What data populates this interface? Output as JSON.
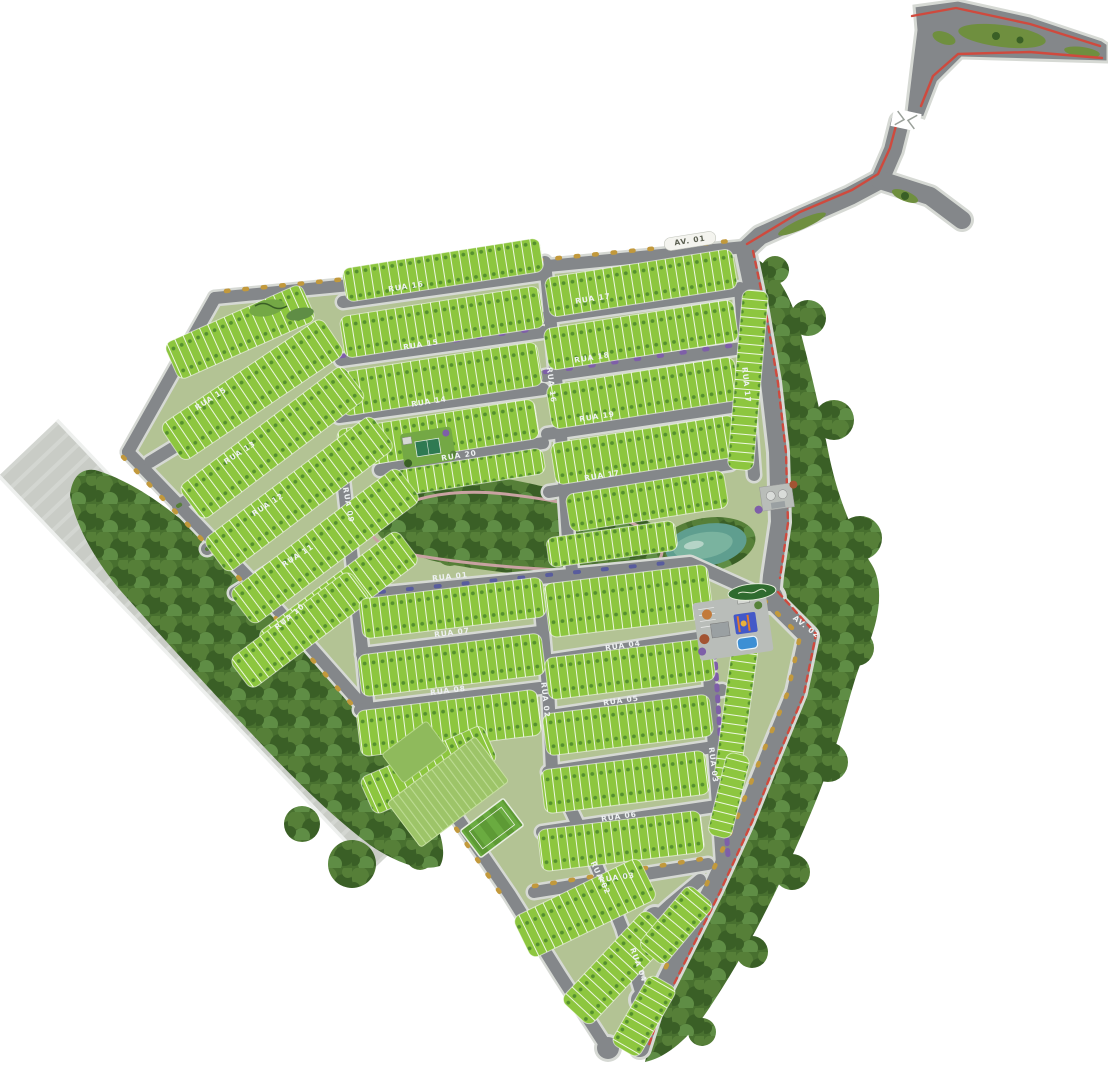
{
  "map_title": "Residential lot subdivision master plan",
  "colors": {
    "lot": "#8dc63f",
    "lotTree": "#4f8a2d",
    "ground": "#b3c394",
    "road": "#84878a",
    "roadCasing": "#d6d9d4",
    "forest": "#48702f",
    "forest2": "#567f38",
    "forest3": "#3a5f26",
    "forest4": "#5f8d45",
    "band": "#c9ccc6",
    "bandEdge": "#eef0ee",
    "lake": "#5f9e8f",
    "lakeLight": "#7fb6a2",
    "trail": "#c9a2a2",
    "red": "#cf4a3e",
    "amber": "#c2993c",
    "purple": "#7e5fa8",
    "carBlue": "#585c9d",
    "court": "#2f7a52",
    "pool": "#3d8fd4",
    "clubBlue": "#4459c8",
    "clubOrange": "#e07b2f",
    "paving": "#b9bdb9",
    "soccer": "#5d9a35",
    "soccer2": "#6aab40",
    "orchard": "#9dc468",
    "orchardLine": "#bddc93",
    "island": "#6f8f3f",
    "sign": "#2f6b2f"
  },
  "streets": [
    {
      "label": "RUA 16",
      "x": 406,
      "y": 287,
      "rot": -9
    },
    {
      "label": "RUA 15",
      "x": 421,
      "y": 345,
      "rot": -9
    },
    {
      "label": "RUA 14",
      "x": 429,
      "y": 402,
      "rot": -9
    },
    {
      "label": "RUA 20",
      "x": 459,
      "y": 456,
      "rot": -9
    },
    {
      "label": "RUA 17",
      "x": 593,
      "y": 299,
      "rot": -9
    },
    {
      "label": "RUA 18",
      "x": 592,
      "y": 358,
      "rot": -9
    },
    {
      "label": "RUA 19",
      "x": 597,
      "y": 417,
      "rot": -9
    },
    {
      "label": "RUA 17",
      "x": 602,
      "y": 476,
      "rot": -9
    },
    {
      "label": "RUA 16",
      "x": 551,
      "y": 385,
      "rot": 83
    },
    {
      "label": "RUA 17",
      "x": 746,
      "y": 385,
      "rot": 84
    },
    {
      "label": "RUA 09",
      "x": 348,
      "y": 505,
      "rot": 80
    },
    {
      "label": "RUA 15",
      "x": 211,
      "y": 399,
      "rot": -33
    },
    {
      "label": "RUA 13",
      "x": 240,
      "y": 453,
      "rot": -33
    },
    {
      "label": "RUA 12",
      "x": 268,
      "y": 505,
      "rot": -33
    },
    {
      "label": "RUA 11",
      "x": 298,
      "y": 556,
      "rot": -33
    },
    {
      "label": "RUA 10",
      "x": 290,
      "y": 617,
      "rot": -40
    },
    {
      "label": "RUA 01",
      "x": 450,
      "y": 577,
      "rot": -6
    },
    {
      "label": "RUA 07",
      "x": 452,
      "y": 633,
      "rot": -7
    },
    {
      "label": "RUA 08",
      "x": 448,
      "y": 691,
      "rot": -7
    },
    {
      "label": "RUA 02",
      "x": 545,
      "y": 700,
      "rot": 84
    },
    {
      "label": "RUA 04",
      "x": 623,
      "y": 646,
      "rot": -8
    },
    {
      "label": "RUA 05",
      "x": 621,
      "y": 701,
      "rot": -8
    },
    {
      "label": "RUA 06",
      "x": 619,
      "y": 817,
      "rot": -8
    },
    {
      "label": "RUA 03",
      "x": 617,
      "y": 878,
      "rot": -8
    },
    {
      "label": "RUA 03",
      "x": 713,
      "y": 765,
      "rot": 83
    },
    {
      "label": "RUA 02",
      "x": 600,
      "y": 878,
      "rot": 64
    },
    {
      "label": "RUA 04",
      "x": 638,
      "y": 965,
      "rot": 70
    },
    {
      "label": "AV. 02",
      "x": 806,
      "y": 627,
      "rot": 38
    },
    {
      "label": "AV. 01",
      "x": 690,
      "y": 241,
      "rot": -9,
      "dark": true
    }
  ]
}
